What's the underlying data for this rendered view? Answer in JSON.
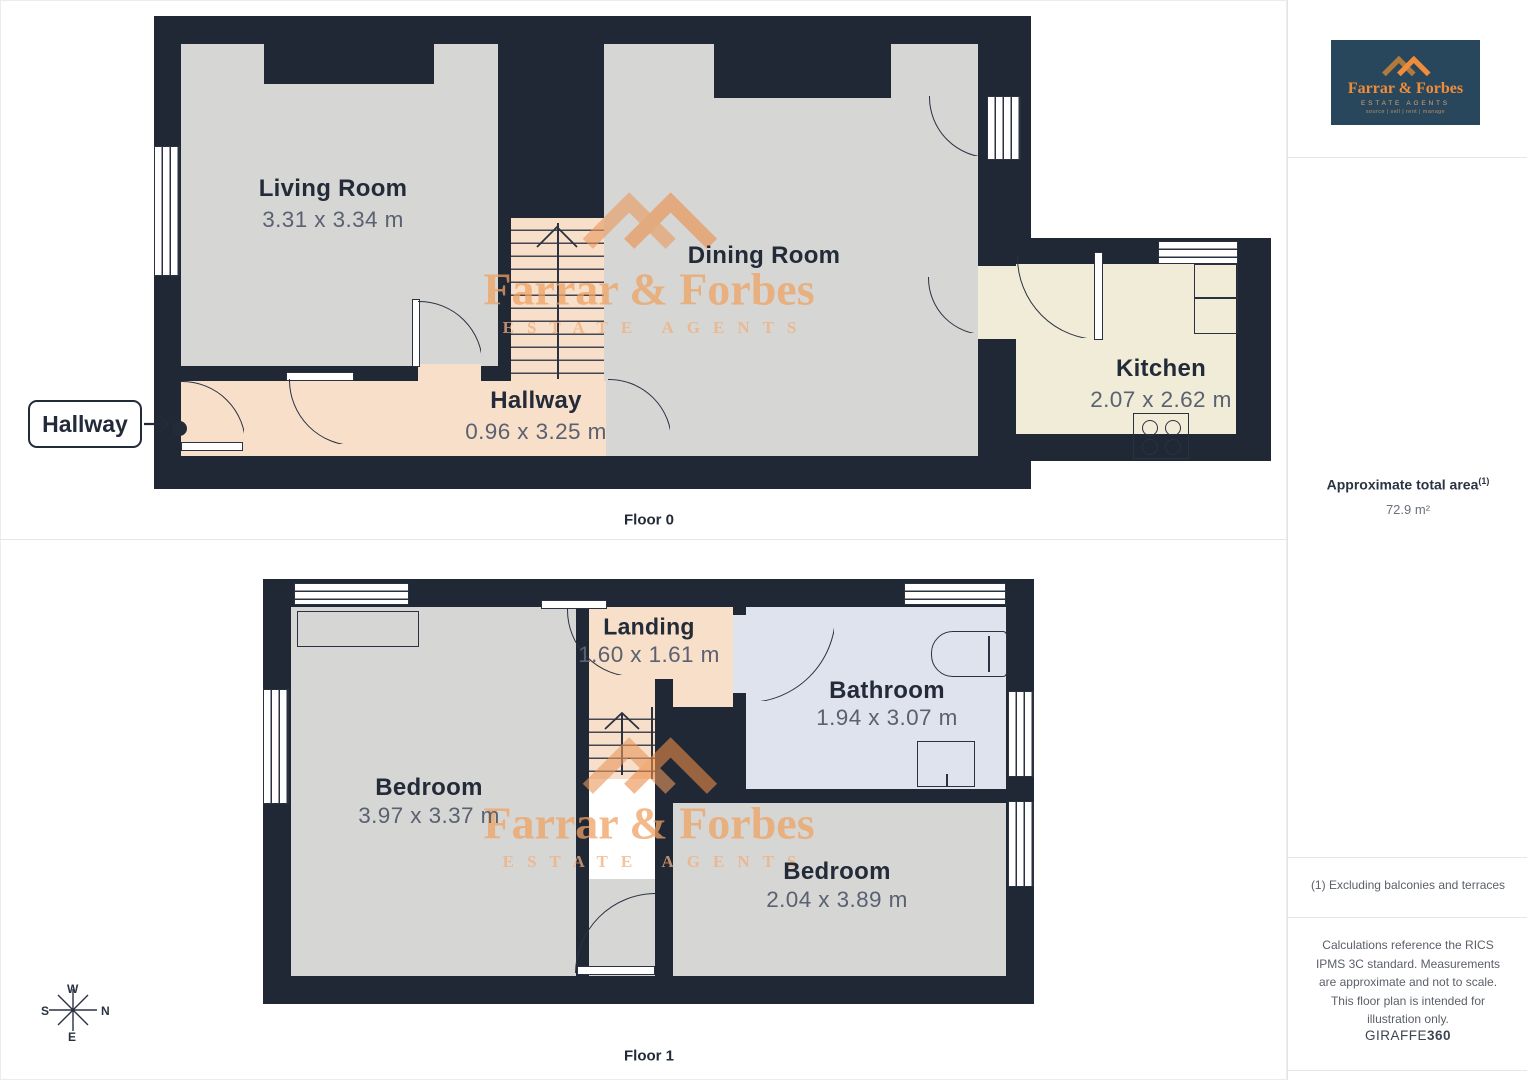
{
  "logo": {
    "brand": "Farrar & Forbes",
    "subtitle": "ESTATE AGENTS",
    "tagline": "source | sell | rent | manage"
  },
  "watermark": {
    "brand": "Farrar & Forbes",
    "subtitle": "ESTATE AGENTS"
  },
  "floor0": {
    "label": "Floor 0",
    "callout": "Hallway",
    "living": {
      "name": "Living Room",
      "dims": "3.31 x 3.34 m"
    },
    "dining": {
      "name": "Dining Room"
    },
    "kitchen": {
      "name": "Kitchen",
      "dims": "2.07 x 2.62 m"
    },
    "hallway": {
      "name": "Hallway",
      "dims": "0.96 x 3.25 m"
    }
  },
  "floor1": {
    "label": "Floor 1",
    "bedroom_left": {
      "name": "Bedroom",
      "dims": "3.97 x 3.37 m"
    },
    "landing": {
      "name": "Landing",
      "dims": "1.60 x 1.61 m"
    },
    "bathroom": {
      "name": "Bathroom",
      "dims": "1.94 x 3.07 m"
    },
    "bedroom_right": {
      "name": "Bedroom",
      "dims": "2.04 x 3.89 m"
    }
  },
  "compass": {
    "n": "N",
    "e": "E",
    "s": "S",
    "w": "W"
  },
  "sidebar": {
    "area_label": "Approximate total area",
    "area_note_sup": "(1)",
    "area_value": "72.9 m²",
    "footnote": "(1) Excluding balconies and terraces",
    "disclaimer": "Calculations reference the RICS IPMS 3C standard. Measurements are approximate and not to scale. This floor plan is intended for illustration only.",
    "vendor_name": "GIRAFFE",
    "vendor_number": "360"
  },
  "colors": {
    "wall": "#202836",
    "room_grey": "#d6d6d5",
    "hall_peach": "#f8dfc9",
    "kitchen_cream": "#f1ecd8",
    "bath_blue": "#dfe3ee",
    "watermark_orange": "#efa263",
    "logo_bg": "#29475c",
    "logo_orange": "#ef8d3b"
  }
}
